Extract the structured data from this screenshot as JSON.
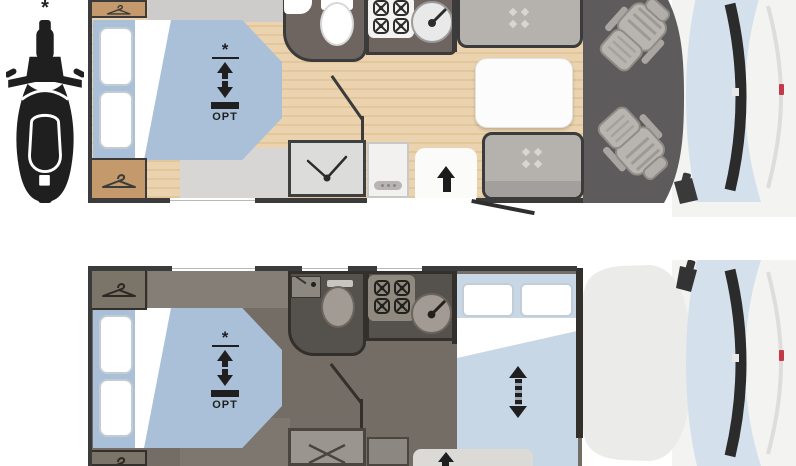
{
  "legend": {
    "note_symbol": "*",
    "vehicle_icon_label": "motorcycle-top-view"
  },
  "plans": {
    "day": {
      "id": "day-layout",
      "drop_down_bed": {
        "symbol": "*",
        "label": "OPT"
      },
      "fixtures": [
        "wardrobe",
        "island-bed",
        "toilet",
        "washbasin",
        "hob",
        "kitchen-sink",
        "shower",
        "entry-door",
        "dinette-table",
        "bench-seats",
        "cab-swivel-seats"
      ]
    },
    "night": {
      "id": "night-layout",
      "drop_down_bed": {
        "symbol": "*",
        "label": "OPT"
      },
      "converted_bed_icon": "extend-arrows",
      "fixtures": [
        "wardrobe",
        "island-bed",
        "toilet",
        "washbasin",
        "hob",
        "kitchen-sink",
        "shower",
        "entry-door",
        "dinette-converted-bed"
      ]
    }
  },
  "colors": {
    "wall": "#3b3b3b",
    "wood_floor_light": "#ecd3af",
    "wood_floor_dark": "#e2c69c",
    "bed_blue": "#a9c0d8",
    "night_bed_blue": "#c7d7e5",
    "wardrobe_tan": "#c49a6c",
    "dark_room": "#6e6560",
    "night_floor": "#746d66",
    "night_room": "#55514c",
    "cab_floor": "#5d5b5c",
    "windshield_blue": "#d4e1ec",
    "vehicle_body": "#f3f3f2",
    "accent_red": "#c23a4a",
    "icon_black": "#1f1f1f"
  }
}
